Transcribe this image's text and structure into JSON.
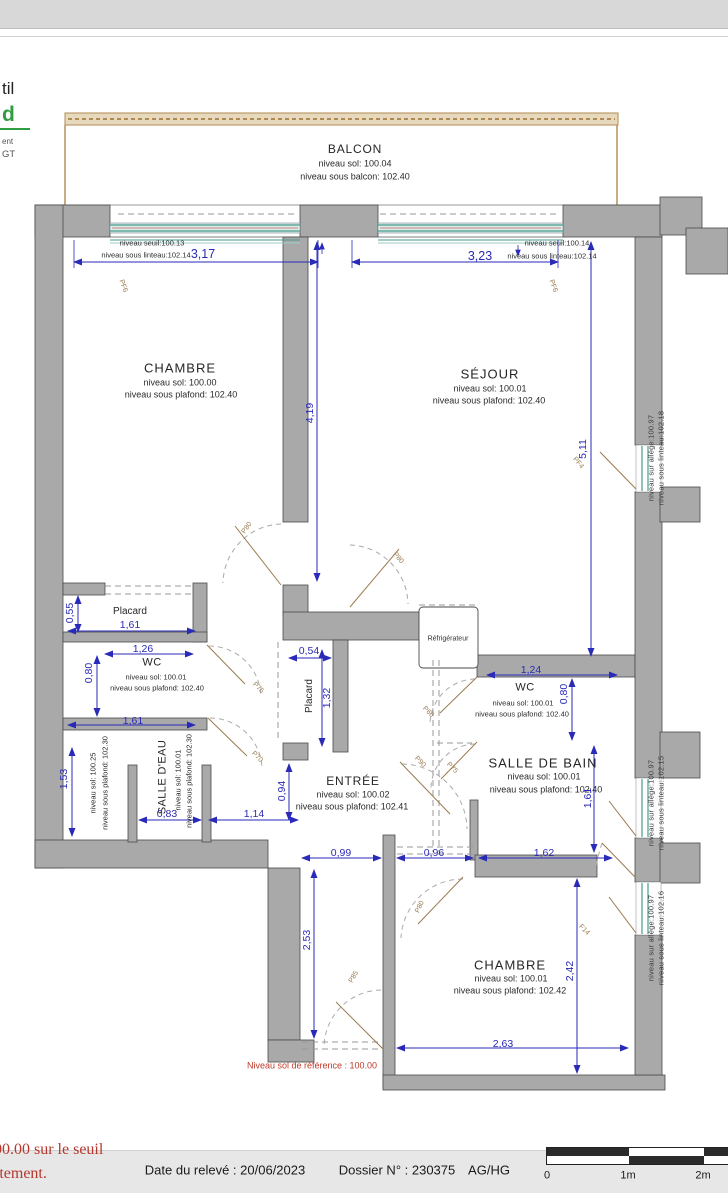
{
  "header": {
    "logo": {
      "frag1": "til",
      "frag2": "d",
      "frag3": "ent",
      "frag4": "GT"
    }
  },
  "balcony": {
    "title": "BALCON",
    "sol": "niveau sol: 100.04",
    "sous_balcon": "niveau sous balcon: 102.40"
  },
  "top_windows": {
    "left": {
      "seuil": "niveau seuil:100.13",
      "linteau": "niveau sous linteau:102.14",
      "dim": "3,17",
      "code": "PF6"
    },
    "right": {
      "seuil": "niveau seuil:100.14",
      "linteau": "niveau sous linteau:102.14",
      "dim": "3,23",
      "code": "PF6"
    }
  },
  "rooms": {
    "chambre1": {
      "name": "CHAMBRE",
      "sol": "niveau sol: 100.00",
      "plafond": "niveau sous plafond: 102.40"
    },
    "sejour": {
      "name": "SÉJOUR",
      "sol": "niveau sol: 100.01",
      "plafond": "niveau sous plafond: 102.40"
    },
    "placard1": {
      "name": "Placard"
    },
    "wc1": {
      "name": "WC",
      "sol": "niveau sol: 100.01",
      "plafond": "niveau sous plafond: 102.40"
    },
    "placard2": {
      "name": "Placard"
    },
    "salle_eau": {
      "name": "SALLE D'EAU",
      "sol": "niveau sol: 100.01",
      "plafond": "niveau sous plafond: 102.30",
      "sol_gaine": "niveau sol: 100.25",
      "plafond_gaine": "niveau sous plafond: 102.30"
    },
    "entree": {
      "name": "ENTRÉE",
      "sol": "niveau sol: 100.02",
      "plafond": "niveau sous plafond: 102.41"
    },
    "wc2": {
      "name": "WC",
      "sol": "niveau sol: 100.01",
      "plafond": "niveau sous plafond: 102.40"
    },
    "sdb": {
      "name": "SALLE DE BAIN",
      "sol": "niveau sol: 100.01",
      "plafond": "niveau sous plafond: 102.40"
    },
    "chambre2": {
      "name": "CHAMBRE",
      "sol": "niveau sol: 100.01",
      "plafond": "niveau sous plafond: 102.42"
    },
    "fridge": {
      "name": "Réfrigérateur"
    }
  },
  "dims": {
    "w1": "3,17",
    "w2": "3,23",
    "h_chambre1": "4,19",
    "h_sejour": "5,11",
    "placard1_h": "0,55",
    "placard1_w": "1,61",
    "wc1_w": "1,26",
    "wc1_h": "0,80",
    "placard2_w": "0,54",
    "placard2_h": "1,32",
    "wc2_w": "1,24",
    "wc2_h": "0,80",
    "se_w": "1,61",
    "se_h": "1,53",
    "se_w2": "0,83",
    "se_pass": "1,14",
    "entree_h": "0,94",
    "pass1": "0,99",
    "pass2": "0,96",
    "sdb_w": "1,62",
    "sdb_h": "1,61",
    "corridor_h": "2,53",
    "chambre2_h": "2,42",
    "chambre2_w": "2,63"
  },
  "codes": {
    "window1": "PF6",
    "window2": "PF6",
    "window_sejour": "PF4",
    "window_chambre2": "F14",
    "door_chambre1": "P80",
    "door_sejour": "P80",
    "door_wc1": "P75",
    "door_salle_eau": "P70",
    "door_wc2": "P66",
    "door_entree": "P90",
    "door_sdb": "P75",
    "door_chambre2": "P80",
    "door_corridor": "P85"
  },
  "levels_right": {
    "sejour": {
      "allege": "niveau sur allège:100.97",
      "linteau": "niveau sous linteau:102.18"
    },
    "sdb": {
      "allege": "niveau sur allège:100.97",
      "linteau": "niveau sous linteau:102.15"
    },
    "chambre2": {
      "allege": "niveau sur allège:100.97",
      "linteau": "niveau sous linteau:102.16"
    }
  },
  "notes": {
    "reference": "Niveau sol de référence : 100.00",
    "partial_line1": "00.00 sur le seuil",
    "partial_line2": "rtement."
  },
  "footer": {
    "date": "Date du relevé : 20/06/2023",
    "dossier": "Dossier N° : 230375",
    "authors": "AG/HG",
    "scale0": "0",
    "scale1": "1m",
    "scale2": "2m"
  }
}
